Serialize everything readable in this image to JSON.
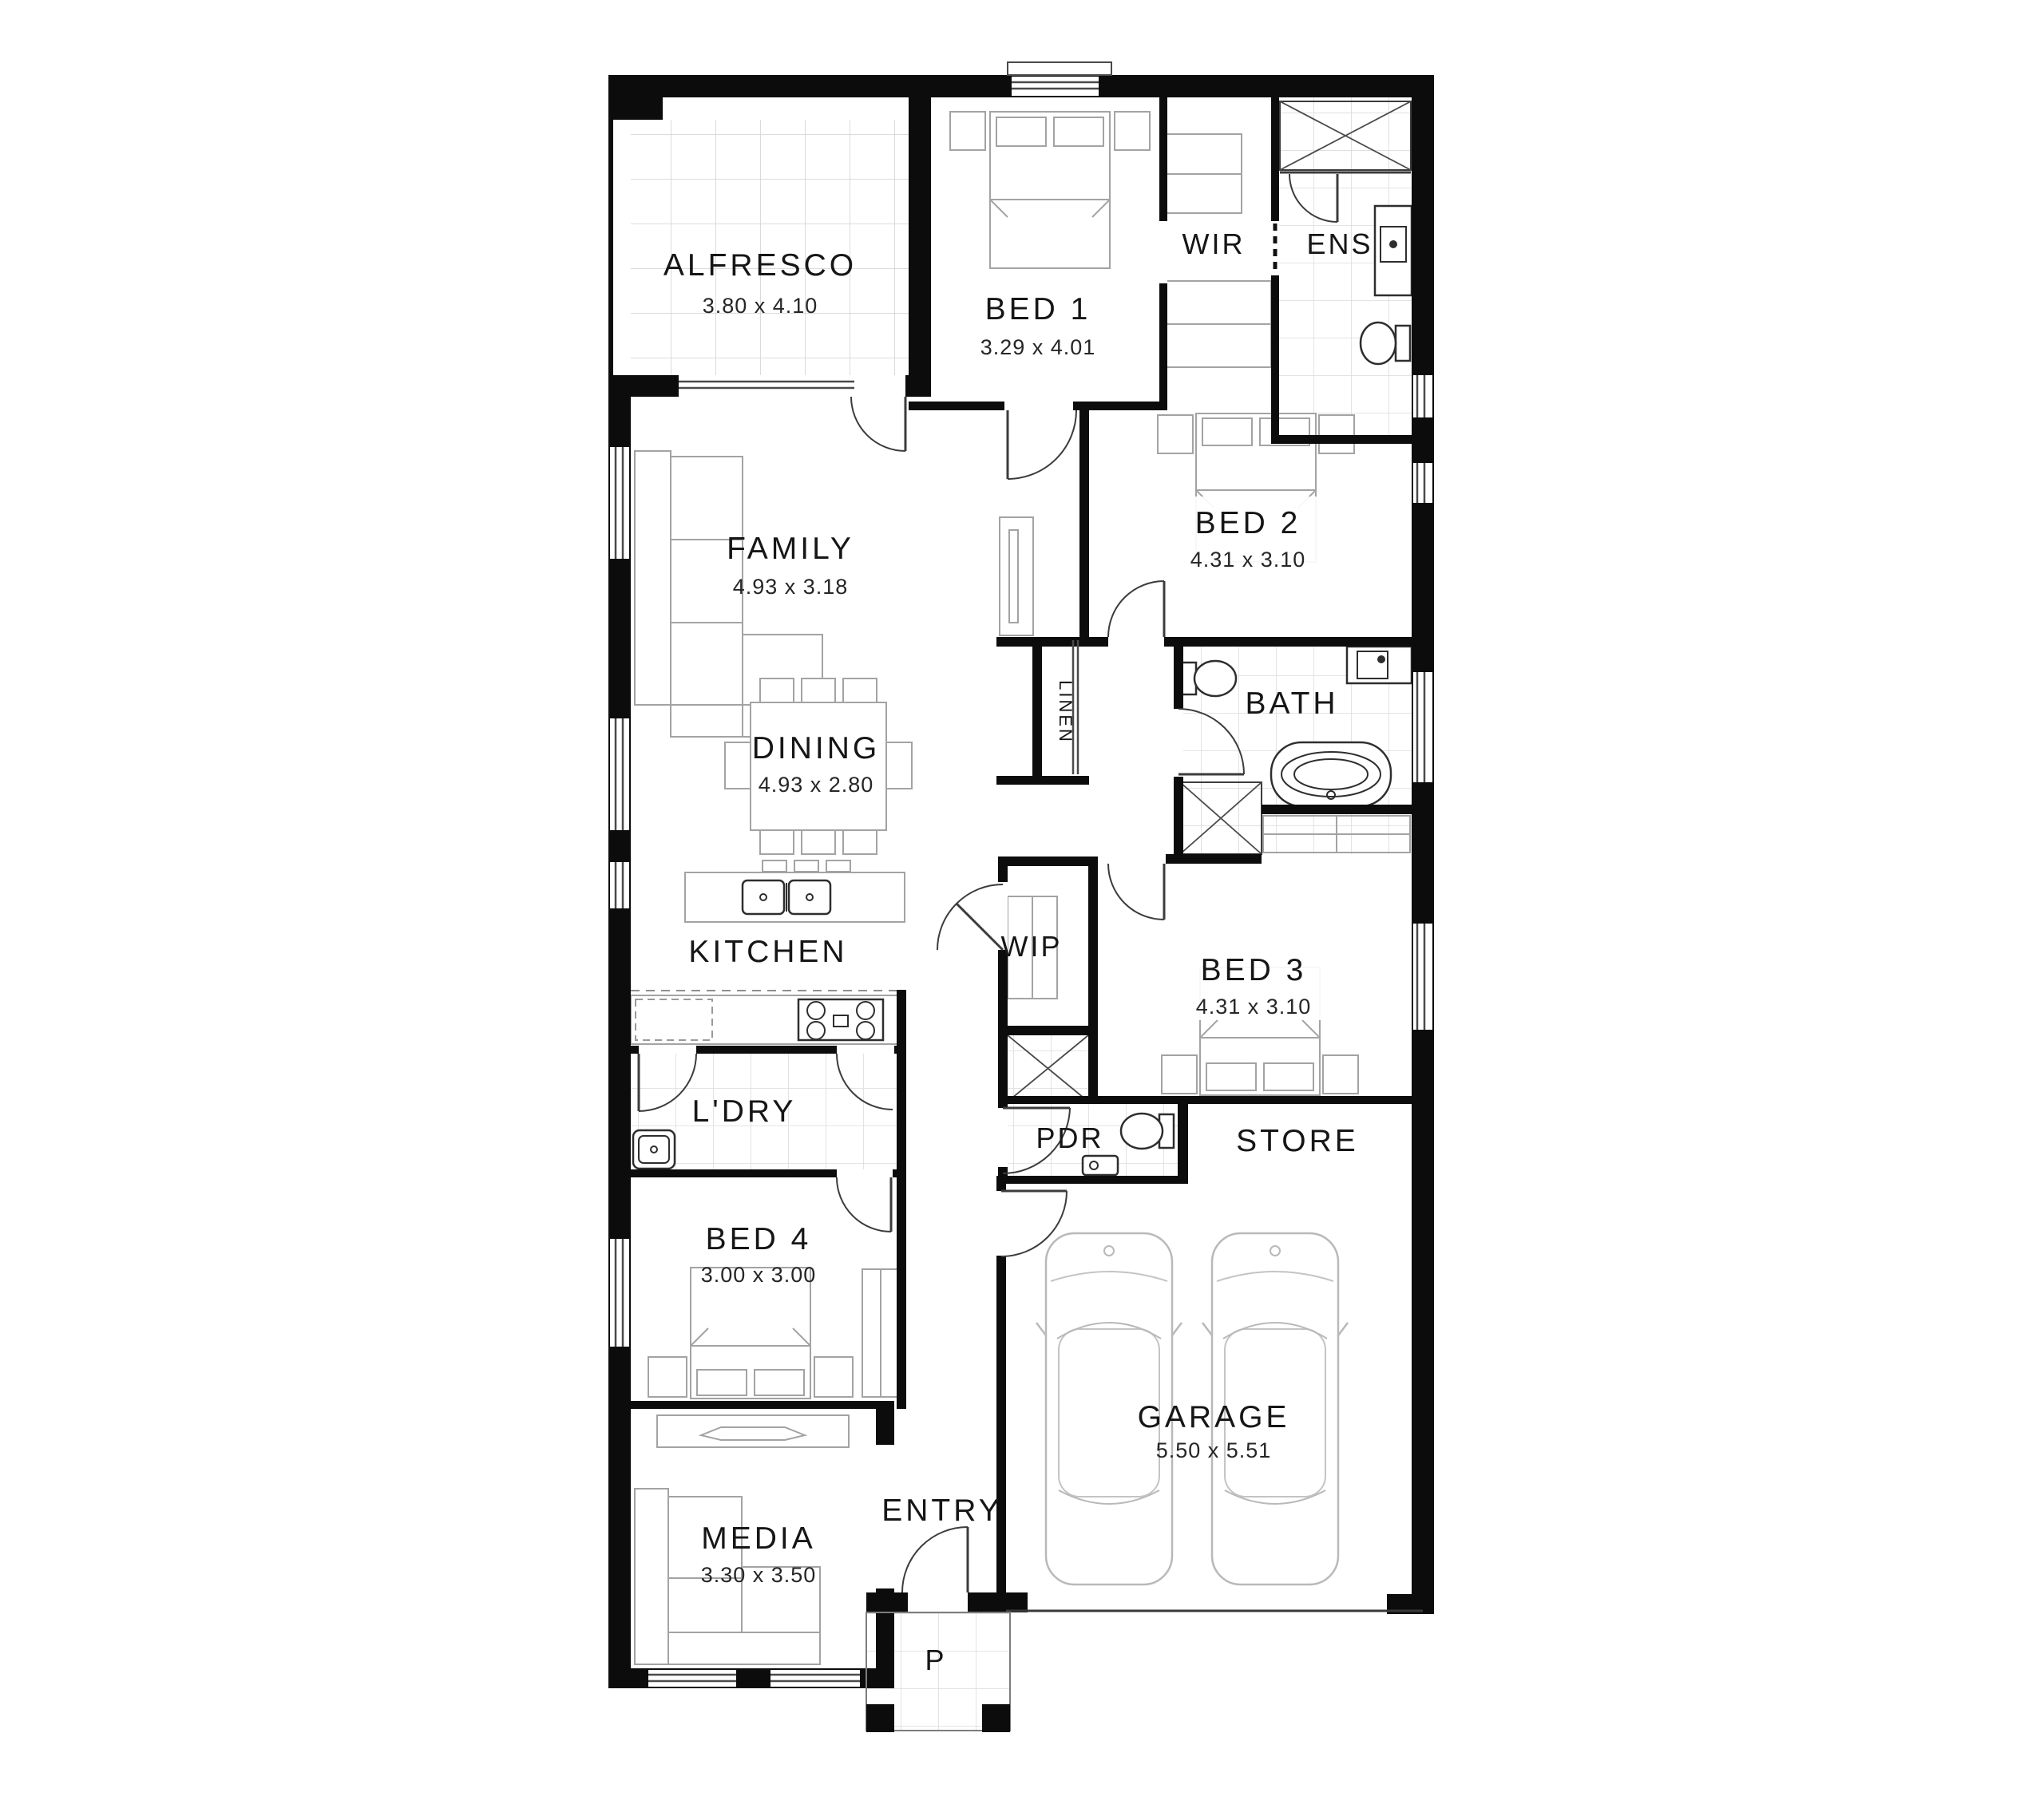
{
  "plan": {
    "rooms": {
      "alfresco": {
        "name": "ALFRESCO",
        "dims": "3.80 x 4.10"
      },
      "bed1": {
        "name": "BED 1",
        "dims": "3.29 x 4.01"
      },
      "wir": {
        "name": "WIR"
      },
      "ens": {
        "name": "ENS"
      },
      "family": {
        "name": "FAMILY",
        "dims": "4.93 x 3.18"
      },
      "bed2": {
        "name": "BED 2",
        "dims": "4.31 x 3.10"
      },
      "linen": {
        "name": "LINEN"
      },
      "bath": {
        "name": "BATH"
      },
      "dining": {
        "name": "DINING",
        "dims": "4.93 x 2.80"
      },
      "kitchen": {
        "name": "KITCHEN"
      },
      "wip": {
        "name": "WIP"
      },
      "bed3": {
        "name": "BED 3",
        "dims": "4.31 x 3.10"
      },
      "ldry": {
        "name": "L'DRY"
      },
      "pdr": {
        "name": "PDR"
      },
      "store": {
        "name": "STORE"
      },
      "bed4": {
        "name": "BED 4",
        "dims": "3.00 x 3.00"
      },
      "garage": {
        "name": "GARAGE",
        "dims": "5.50 x 5.51"
      },
      "media": {
        "name": "MEDIA",
        "dims": "3.30 x 3.50"
      },
      "entry": {
        "name": "ENTRY"
      },
      "porch": {
        "name": "P"
      }
    },
    "colors": {
      "wall": "#0c0c0c",
      "furniture": "#a3a3a3",
      "tile": "#d9d9d9",
      "text": "#161616"
    }
  }
}
